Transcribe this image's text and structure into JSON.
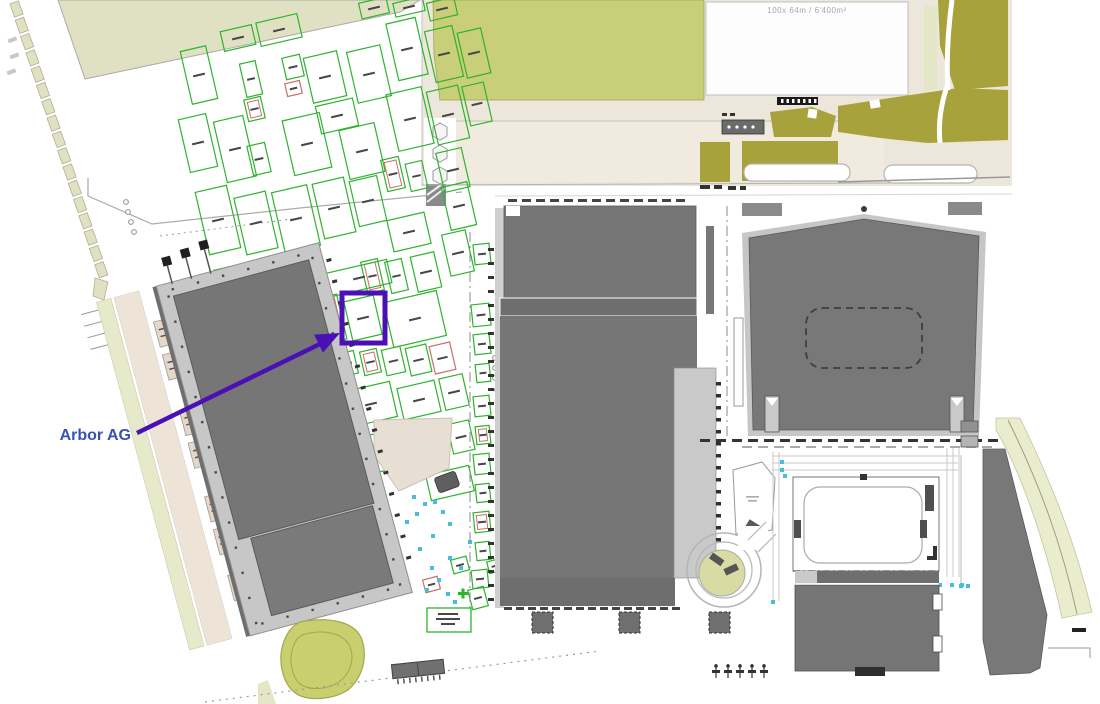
{
  "page": {
    "background": "#FFFFFF"
  },
  "field_label": {
    "text": "100x  64m  /  6'400m²",
    "color": "#A8A8A8"
  },
  "annotation": {
    "label": "Arbor AG",
    "label_color": "#3A50B2",
    "arrow_color": "#4B10B5"
  },
  "colors": {
    "building_dark": "#767676",
    "building_band": "#6E6E6E",
    "platform_gray": "#C7C7C7",
    "light_slab": "#C9C9C9",
    "field_green": "#C9CF79",
    "olive": "#A8A23C",
    "pale_green": "#E3E7C8",
    "beige": "#EDE6DA",
    "stall_green": "#2DB32D",
    "stall_red": "#C96F6B",
    "cyan_dot": "#49BEDB"
  },
  "map": {
    "stall_stroke": "#2DB32D",
    "stall_alt_stroke": "#C96F6B",
    "accent_cyan": "#49BEDB",
    "kiosk_fill": "#E5D8C9",
    "plot_dash_fill": "#E0E1C3",
    "stalls": [
      [
        186,
        48,
        26,
        54
      ],
      [
        222,
        28,
        32,
        20
      ],
      [
        258,
        18,
        42,
        24
      ],
      [
        243,
        62,
        16,
        34
      ],
      [
        284,
        56,
        18,
        22
      ],
      [
        286,
        82,
        15,
        13,
        "R"
      ],
      [
        246,
        98,
        17,
        22,
        "r"
      ],
      [
        308,
        54,
        34,
        46
      ],
      [
        352,
        48,
        34,
        52
      ],
      [
        392,
        20,
        30,
        58
      ],
      [
        360,
        0,
        28,
        16
      ],
      [
        394,
        0,
        30,
        14
      ],
      [
        428,
        0,
        28,
        18
      ],
      [
        430,
        28,
        28,
        52
      ],
      [
        462,
        30,
        24,
        46
      ],
      [
        288,
        116,
        38,
        56
      ],
      [
        318,
        102,
        38,
        28
      ],
      [
        344,
        126,
        36,
        50
      ],
      [
        392,
        90,
        36,
        58
      ],
      [
        432,
        88,
        32,
        54
      ],
      [
        466,
        84,
        22,
        40
      ],
      [
        184,
        116,
        28,
        54
      ],
      [
        220,
        118,
        30,
        62
      ],
      [
        250,
        144,
        18,
        30
      ],
      [
        384,
        158,
        18,
        32,
        "r"
      ],
      [
        408,
        162,
        17,
        28
      ],
      [
        440,
        150,
        26,
        40
      ],
      [
        202,
        188,
        32,
        64
      ],
      [
        240,
        194,
        32,
        58
      ],
      [
        278,
        188,
        36,
        62
      ],
      [
        318,
        180,
        32,
        56
      ],
      [
        354,
        178,
        28,
        46
      ],
      [
        446,
        184,
        26,
        44
      ],
      [
        390,
        216,
        38,
        32
      ],
      [
        220,
        266,
        32,
        60
      ],
      [
        256,
        274,
        32,
        54
      ],
      [
        292,
        270,
        38,
        42
      ],
      [
        446,
        232,
        24,
        42
      ],
      [
        364,
        260,
        17,
        32,
        "r"
      ],
      [
        388,
        260,
        17,
        32
      ],
      [
        414,
        254,
        24,
        36
      ],
      [
        328,
        266,
        62,
        24
      ],
      [
        320,
        296,
        22,
        46,
        "r"
      ],
      [
        348,
        298,
        30,
        40
      ],
      [
        388,
        296,
        54,
        46
      ],
      [
        318,
        352,
        16,
        23,
        "r"
      ],
      [
        340,
        352,
        16,
        23
      ],
      [
        362,
        350,
        17,
        24,
        "r"
      ],
      [
        384,
        348,
        19,
        26
      ],
      [
        408,
        346,
        21,
        28
      ],
      [
        432,
        344,
        21,
        28,
        "R"
      ],
      [
        250,
        340,
        44,
        52
      ],
      [
        204,
        298,
        42,
        62
      ],
      [
        204,
        370,
        42,
        58
      ],
      [
        298,
        382,
        42,
        40
      ],
      [
        348,
        386,
        46,
        36
      ],
      [
        400,
        384,
        38,
        32
      ],
      [
        442,
        376,
        24,
        32
      ],
      [
        240,
        442,
        30,
        48
      ],
      [
        276,
        436,
        34,
        46
      ],
      [
        316,
        432,
        32,
        42
      ],
      [
        352,
        436,
        32,
        38
      ],
      [
        388,
        434,
        30,
        36
      ],
      [
        422,
        428,
        24,
        32
      ],
      [
        450,
        422,
        22,
        30
      ],
      [
        204,
        440,
        30,
        50
      ],
      [
        298,
        486,
        26,
        22
      ],
      [
        330,
        484,
        24,
        20
      ],
      [
        358,
        482,
        24,
        20
      ],
      [
        428,
        470,
        44,
        26
      ]
    ],
    "strip_stalls": [
      [
        474,
        244,
        16,
        20
      ],
      [
        472,
        304,
        18,
        22
      ],
      [
        474,
        334,
        16,
        20
      ],
      [
        476,
        364,
        14,
        18
      ],
      [
        474,
        396,
        16,
        20
      ],
      [
        476,
        426,
        14,
        18,
        "r"
      ],
      [
        474,
        454,
        16,
        20
      ],
      [
        476,
        484,
        14,
        18
      ],
      [
        474,
        512,
        16,
        20,
        "r"
      ],
      [
        476,
        542,
        14,
        18
      ],
      [
        472,
        570,
        16,
        18
      ]
    ],
    "scatter_stalls": [
      [
        424,
        578,
        15,
        13,
        "R"
      ],
      [
        452,
        558,
        16,
        14
      ],
      [
        470,
        588,
        16,
        20
      ],
      [
        497,
        584,
        16,
        14,
        "r"
      ],
      [
        488,
        560,
        14,
        12
      ]
    ],
    "cyan_dots": [
      [
        412,
        495
      ],
      [
        423,
        502
      ],
      [
        433,
        500
      ],
      [
        441,
        510
      ],
      [
        415,
        512
      ],
      [
        448,
        522
      ],
      [
        431,
        534
      ],
      [
        418,
        547
      ],
      [
        448,
        556
      ],
      [
        430,
        566
      ],
      [
        437,
        578
      ],
      [
        446,
        592
      ],
      [
        453,
        600
      ],
      [
        425,
        588
      ],
      [
        459,
        566
      ],
      [
        468,
        540
      ],
      [
        405,
        520
      ]
    ],
    "tan_kiosks": [
      [
        188,
        296
      ],
      [
        188,
        330
      ],
      [
        190,
        388
      ],
      [
        190,
        422
      ],
      [
        192,
        478
      ],
      [
        192,
        512
      ],
      [
        194,
        560
      ]
    ],
    "tree_circles": [
      [
        126,
        202
      ],
      [
        128,
        212
      ],
      [
        131,
        222
      ],
      [
        134,
        232
      ],
      [
        495,
        358
      ],
      [
        495,
        368
      ],
      [
        495,
        378
      ],
      [
        497,
        390
      ]
    ],
    "plot_dashes": {
      "x0": 12,
      "y0": 2,
      "dx": 5.3,
      "dy": 16.3,
      "count": 17
    },
    "tree_symbols_x": [
      716,
      728,
      740,
      752,
      764
    ]
  }
}
